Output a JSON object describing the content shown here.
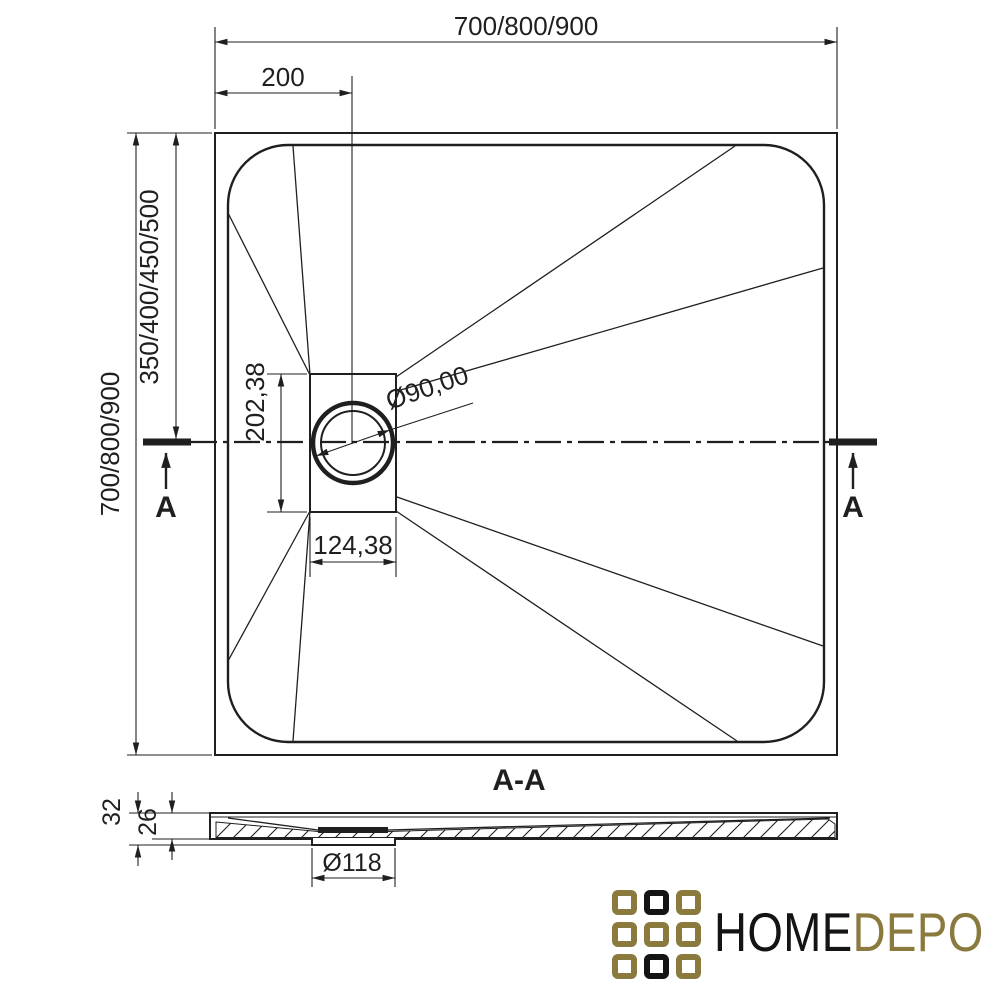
{
  "page": {
    "background": "#ffffff"
  },
  "colors": {
    "ink": "#1f1f1f",
    "logo_gold": "#8a7a3d",
    "logo_black": "#141414"
  },
  "top_view": {
    "width_dim": "700/800/900",
    "drain_offset_x_dim": "200",
    "height_dim": "700/800/900",
    "drain_offset_y_dim": "350/400/450/500",
    "drain_plate_height_dim": "202,38",
    "drain_plate_width_dim": "124,38",
    "drain_diameter_dim": "Ø90,00",
    "section_label_left": "A",
    "section_label_right": "A"
  },
  "section_view": {
    "title": "A-A",
    "overall_height_dim": "32",
    "body_height_dim": "26",
    "drain_hole_dim": "Ø118"
  },
  "logo": {
    "name_part1": "HOME",
    "name_part2": "DEPO",
    "grid": [
      [
        "gold",
        "black",
        "gold"
      ],
      [
        "gold",
        "gold",
        "gold"
      ],
      [
        "gold",
        "black",
        "gold"
      ]
    ]
  }
}
